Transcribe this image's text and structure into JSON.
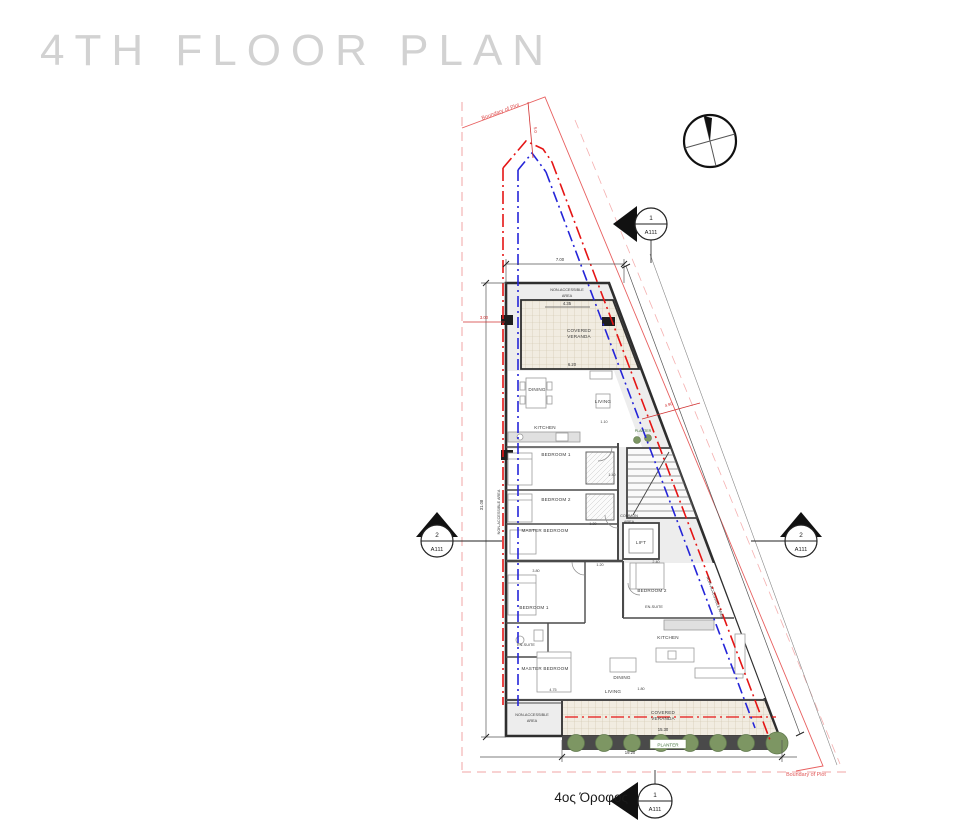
{
  "header": {
    "title": "4TH FLOOR PLAN"
  },
  "footer": {
    "floor_label": "4ος Όροφος"
  },
  "colors": {
    "title_gray": "#d2d2d2",
    "boundary_red": "#e86060",
    "centerline_red": "#e51515",
    "centerline_blue": "#2525d8",
    "planter_green": "#7d9663",
    "tile_beige": "#f1ece1"
  },
  "plan": {
    "boundary": {
      "top_label": "Boundary of Plot",
      "bottom_label": "Boundary of Plot"
    },
    "areas": {
      "non_accessible_line1": "NON-ACCESSIBLE",
      "non_accessible_line2": "AREA",
      "non_accessible_full": "NON-ACCESSIBLE AREA",
      "covered_veranda_line1": "COVERED",
      "covered_veranda_line2": "VERANDA",
      "common_area_line1": "COMMON",
      "common_area_line2": "AREA",
      "planter": "PLANTER"
    },
    "rooms": {
      "apt_top": {
        "dining": "DINING",
        "living": "LIVING",
        "kitchen": "KITCHEN",
        "bedroom1": "BEDROOM 1",
        "bedroom2": "BEDROOM 2",
        "master": "MASTER BEDROOM"
      },
      "apt_bottom": {
        "bedroom1": "BEDROOM 1",
        "bedroom2": "BEDROOM 2",
        "ensuite1": "EN-SUITE",
        "ensuite2": "EN-SUITE",
        "kitchen": "KITCHEN",
        "master": "MASTER BEDROOM",
        "dining": "DINING",
        "living": "LIVING"
      },
      "lift": "LIFT"
    },
    "dimensions": {
      "top_width": "7.00",
      "veranda_depth": "4.35",
      "living_width": "6.20",
      "offset_left": "3.00",
      "offset_top": "5.0",
      "side_length": "31.08",
      "offset_diag": "4.90",
      "c110": "1.10",
      "c120": "1.20",
      "c130": "1.30",
      "c140": "1.40",
      "c180": "1.80",
      "c240": "2.40",
      "c380": "3.80",
      "c475": "4.75",
      "veranda_bottom_width": "15.30",
      "bottom_width": "19.20"
    },
    "markers": {
      "top": {
        "number": "1",
        "sheet": "A111"
      },
      "left": {
        "number": "2",
        "sheet": "A111"
      },
      "right": {
        "number": "2",
        "sheet": "A111"
      },
      "bottom": {
        "number": "1",
        "sheet": "A111"
      }
    }
  }
}
